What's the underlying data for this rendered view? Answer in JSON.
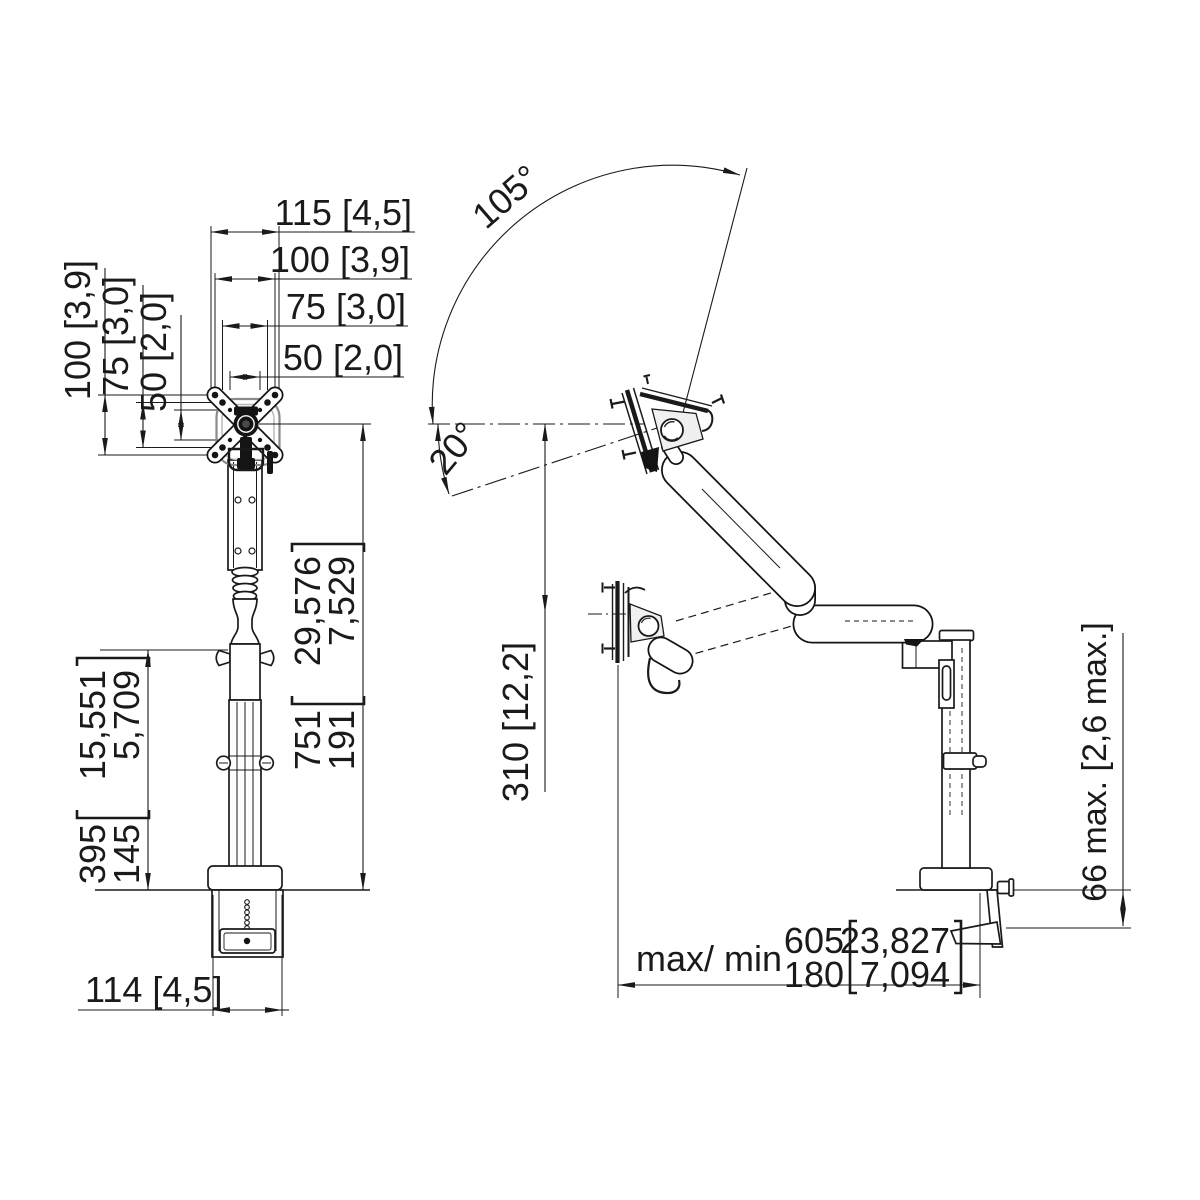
{
  "document": {
    "type": "technical dimension drawing",
    "subject": "desk-mounted monitor arm, front view and side view",
    "background_color": "#ffffff",
    "line_color": "#1a1a1a"
  },
  "front_view": {
    "width_dims": {
      "adapter": "115 [4,5]",
      "vesa_100": "100 [3,9]",
      "vesa_75": "75 [3,0]",
      "vesa_50": "50 [2,0]"
    },
    "height_dims": {
      "vesa_100": "100 [3,9]",
      "vesa_75": "75 [3,0]",
      "vesa_50": "50 [2,0]"
    },
    "total_height": {
      "max_mm": "751",
      "min_mm": "191",
      "max_in": "29,576",
      "min_in": "7,529"
    },
    "pole_height": {
      "max_mm": "395",
      "min_mm": "145",
      "max_in": "15,551",
      "min_in": "5,709"
    },
    "clamp_width": "114 [4,5]"
  },
  "side_view": {
    "tilt_up_angle": "105°",
    "tilt_down_angle": "20°",
    "head_drop": "310 [12,2]",
    "reach": {
      "label": "max/ min",
      "max_mm": "605",
      "min_mm": "180",
      "max_in": "23,827",
      "min_in": "7,094"
    },
    "desk_thickness": "66 max. [2,6 max.]"
  }
}
